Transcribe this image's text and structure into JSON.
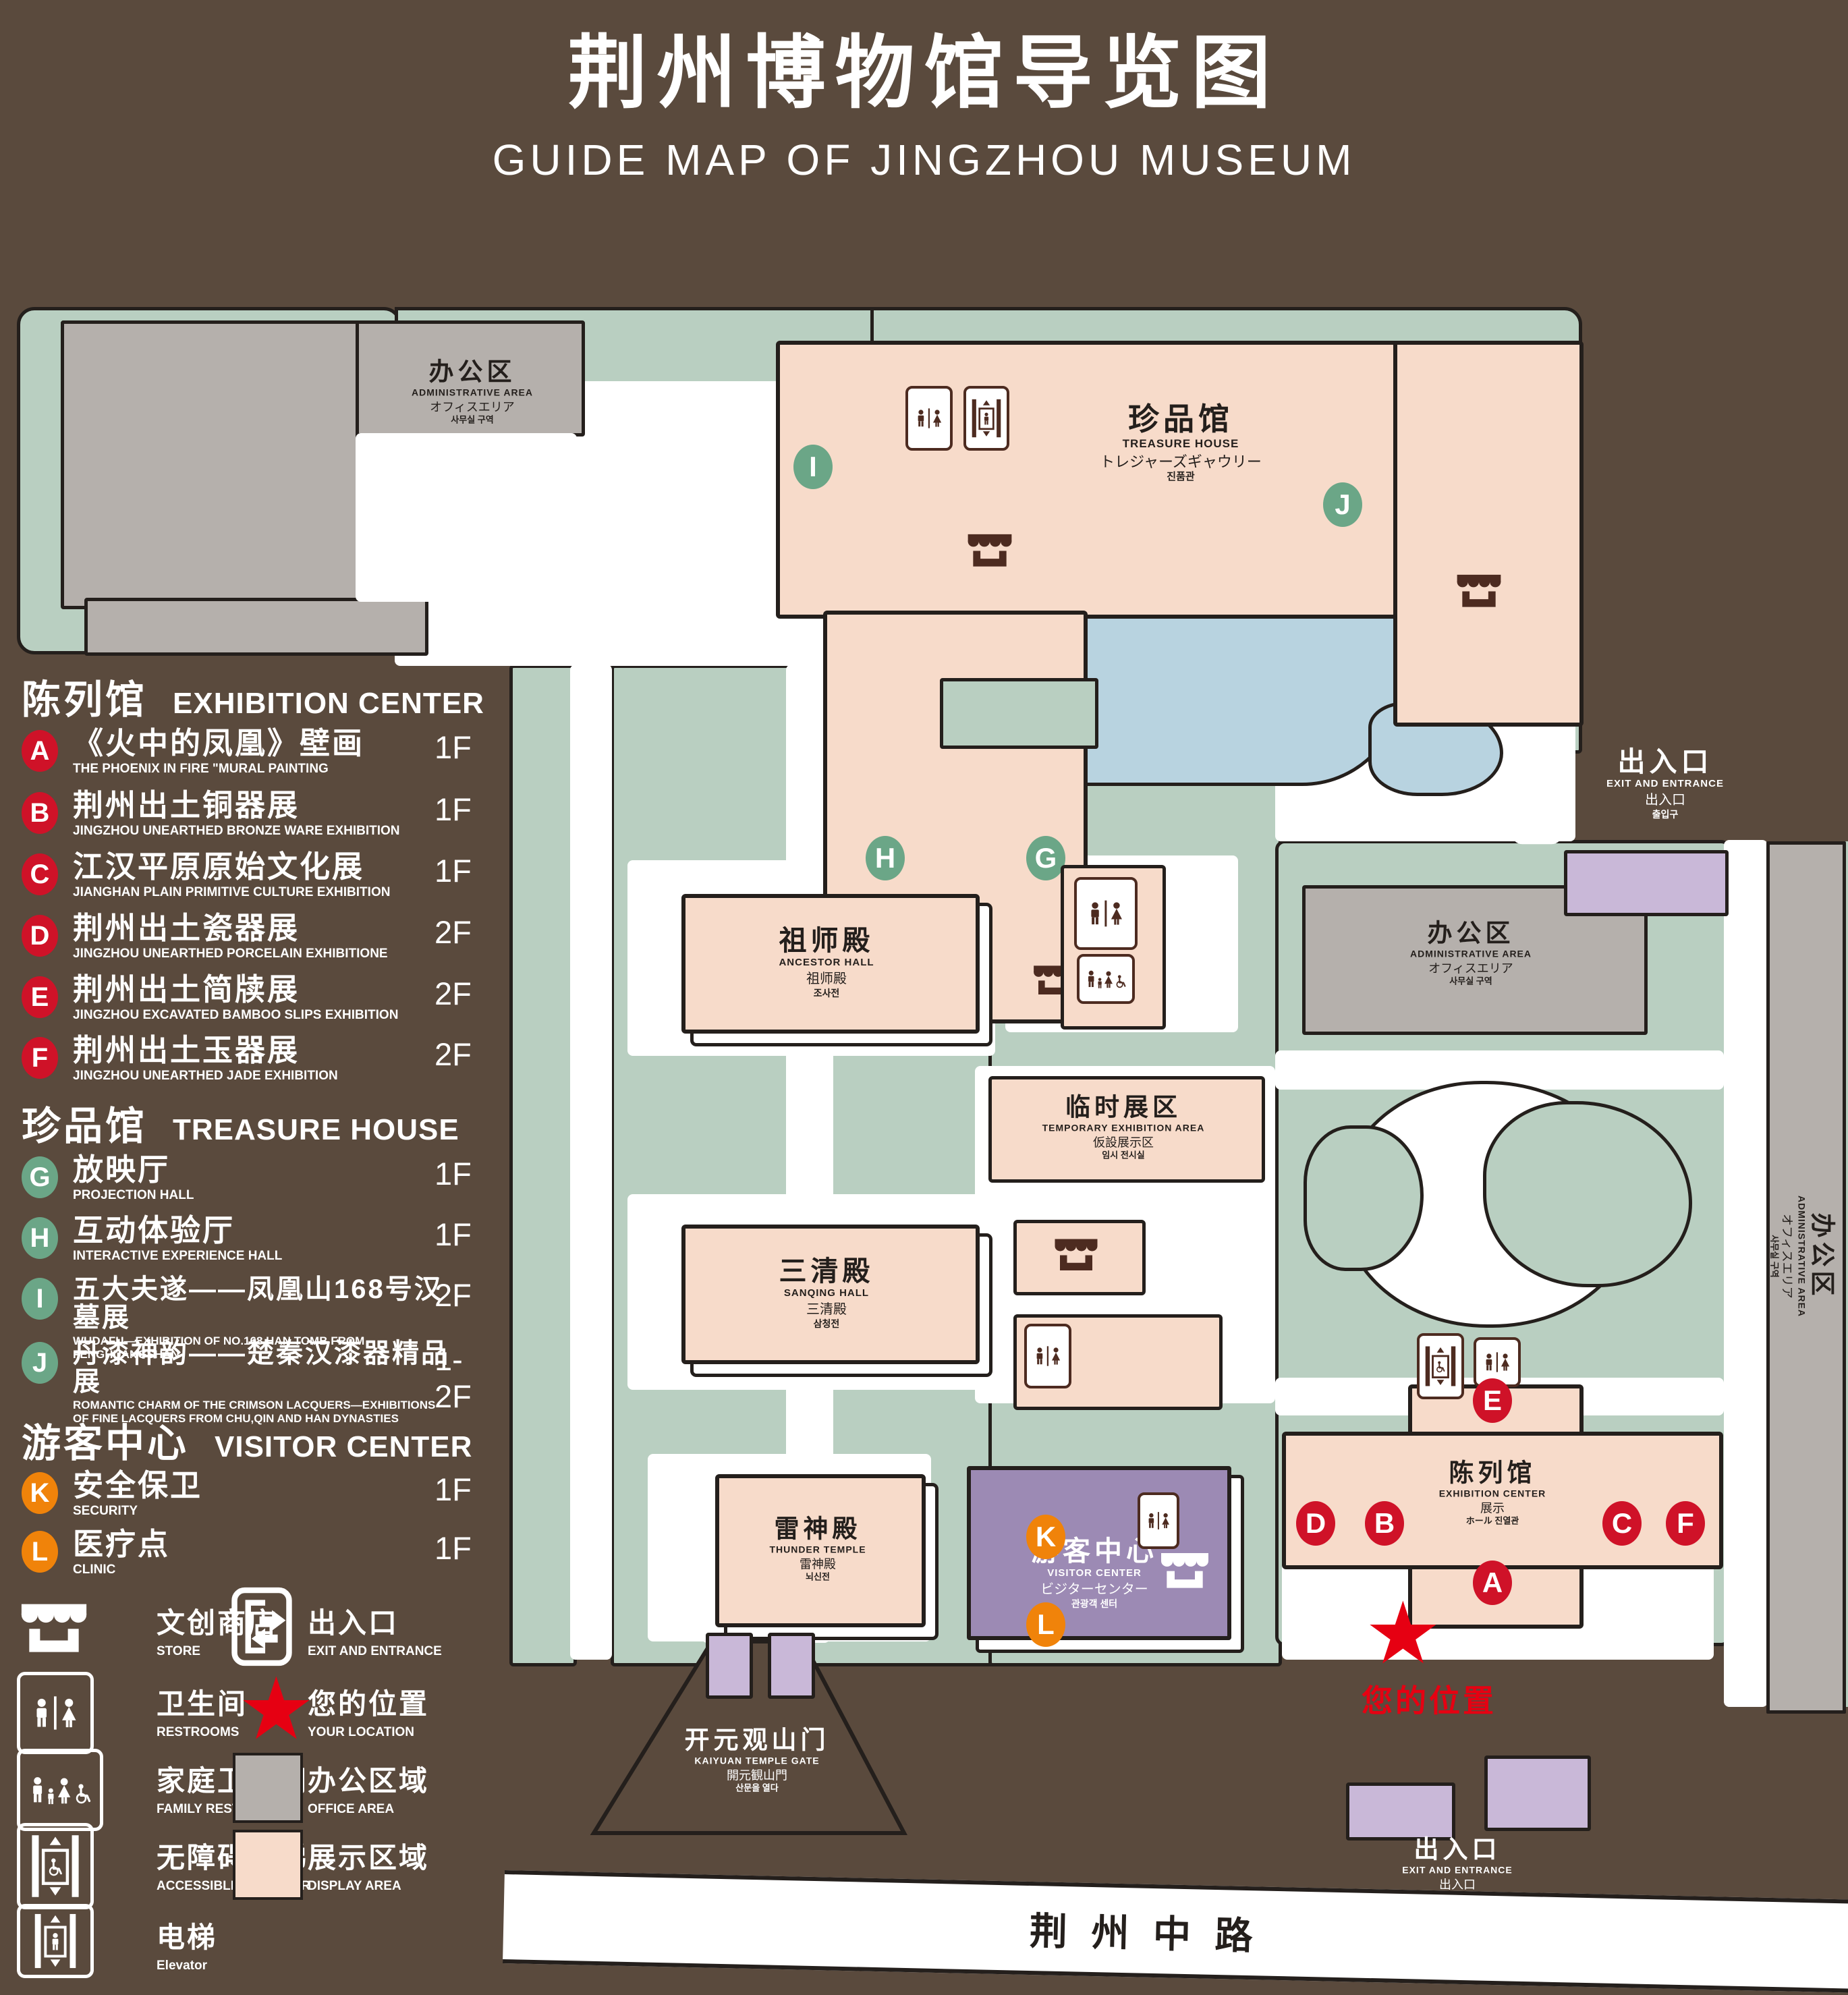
{
  "title": {
    "cn": "荆州博物馆导览图",
    "en": "GUIDE MAP OF JINGZHOU MUSEUM"
  },
  "legend": {
    "exhibition": {
      "cn": "陈列馆",
      "en": "EXHIBITION CENTER",
      "items": [
        {
          "key": "A",
          "cn": "《火中的凤凰》壁画",
          "en": "THE PHOENIX IN FIRE \"MURAL PAINTING",
          "floor": "1F"
        },
        {
          "key": "B",
          "cn": "荆州出土铜器展",
          "en": "JINGZHOU UNEARTHED BRONZE WARE EXHIBITION",
          "floor": "1F"
        },
        {
          "key": "C",
          "cn": "江汉平原原始文化展",
          "en": "JIANGHAN PLAIN PRIMITIVE CULTURE EXHIBITION",
          "floor": "1F"
        },
        {
          "key": "D",
          "cn": "荆州出土瓷器展",
          "en": "JINGZHOU UNEARTHED PORCELAIN EXHIBITIONE",
          "floor": "2F"
        },
        {
          "key": "E",
          "cn": "荆州出土简牍展",
          "en": "JINGZHOU EXCAVATED BAMBOO SLIPS EXHIBITION",
          "floor": "2F"
        },
        {
          "key": "F",
          "cn": "荆州出土玉器展",
          "en": "JINGZHOU UNEARTHED JADE EXHIBITION",
          "floor": "2F"
        }
      ]
    },
    "treasure": {
      "cn": "珍品馆",
      "en": "TREASURE HOUSE",
      "items": [
        {
          "key": "G",
          "cn": "放映厅",
          "en": "PROJECTION HALL",
          "floor": "1F"
        },
        {
          "key": "H",
          "cn": "互动体验厅",
          "en": "INTERACTIVE EXPERIENCE HALL",
          "floor": "1F"
        },
        {
          "key": "I",
          "cn": "五大夫遂——凤凰山168号汉墓展",
          "en": "WUDAFU—EXHIBITION OF NO.168 HAN TOMB FROM FENGHUANGSHAN",
          "floor": "2F"
        },
        {
          "key": "J",
          "cn": "丹漆神韵——楚秦汉漆器精品展",
          "en": "ROMANTIC CHARM OF THE CRIMSON LACQUERS—EXHIBITIONS OF FINE LACQUERS FROM CHU,QIN AND HAN DYNASTIES",
          "floor": "1-2F"
        }
      ]
    },
    "visitor": {
      "cn": "游客中心",
      "en": "VISITOR CENTER",
      "items": [
        {
          "key": "K",
          "cn": "安全保卫",
          "en": "SECURITY",
          "floor": "1F"
        },
        {
          "key": "L",
          "cn": "医疗点",
          "en": "CLINIC",
          "floor": "1F"
        }
      ]
    },
    "facilities": [
      {
        "icon": "store-icon",
        "cn": "文创商店",
        "en": "STORE"
      },
      {
        "icon": "exit-icon",
        "cn": "出入口",
        "en": "EXIT AND ENTRANCE"
      },
      {
        "icon": "restroom-icon",
        "cn": "卫生间",
        "en": "RESTROOMS"
      },
      {
        "icon": "location-star-icon",
        "cn": "您的位置",
        "en": "YOUR LOCATION"
      },
      {
        "icon": "family-restroom-icon",
        "cn": "家庭卫生间",
        "en": "FAMILY RESTROOMS"
      },
      {
        "icon": "office-area-swatch",
        "cn": "办公区域",
        "en": "OFFICE AREA"
      },
      {
        "icon": "accessible-elevator-icon",
        "cn": "无障碍电梯",
        "en": "ACCESSIBLE ELEVATOR"
      },
      {
        "icon": "display-area-swatch",
        "cn": "展示区域",
        "en": "DISPLAY AREA"
      },
      {
        "icon": "elevator-icon",
        "cn": "电梯",
        "en": "Elevator"
      }
    ]
  },
  "map": {
    "admin": {
      "cn": "办公区",
      "en": "ADMINISTRATIVE AREA",
      "jp": "オフィスエリア",
      "kr": "사무실 구역"
    },
    "treasure_house": {
      "cn": "珍品馆",
      "en": "TREASURE HOUSE",
      "jp": "トレジャーズギャウリー",
      "kr": "진품관"
    },
    "ancestor_hall": {
      "cn": "祖师殿",
      "en": "ANCESTOR HALL",
      "jp": "祖师殿",
      "kr": "조사전"
    },
    "sanqing_hall": {
      "cn": "三清殿",
      "en": "SANQING HALL",
      "jp": "三清殿",
      "kr": "삼청전"
    },
    "thunder_temple": {
      "cn": "雷神殿",
      "en": "THUNDER TEMPLE",
      "jp": "雷神殿",
      "kr": "뇌신전"
    },
    "temporary_area": {
      "cn": "临时展区",
      "en": "TEMPORARY EXHIBITION AREA",
      "jp": "仮設展示区",
      "kr": "임시 전시실"
    },
    "visitor_center": {
      "cn": "游客中心",
      "en": "VISITOR CENTER",
      "jp": "ビジターセンター",
      "kr": "관광객 센터"
    },
    "exhibition_center": {
      "cn": "陈列馆",
      "en": "EXHIBITION CENTER",
      "jp": "展示",
      "kr": "ホール 진열관"
    },
    "gate": {
      "cn": "开元观山门",
      "en": "KAIYUAN TEMPLE GATE",
      "jp": "開元観山門",
      "kr": "산문을 열다"
    },
    "exit": {
      "cn": "出入口",
      "en": "EXIT AND ENTRANCE",
      "jp": "出入口",
      "kr": "출입구"
    },
    "road": "荆 州 中 路",
    "your_location": "您的位置",
    "markers": {
      "a": "A",
      "b": "B",
      "c": "C",
      "d": "D",
      "e": "E",
      "f": "F",
      "g": "G",
      "h": "H",
      "i": "I",
      "j": "J",
      "k": "K",
      "l": "L"
    }
  },
  "colors": {
    "background": "#5a4a3d",
    "park_green": "#b9cfc1",
    "display_pink": "#f7dbca",
    "office_gray": "#b5b0ac",
    "pond_blue": "#b8d3e0",
    "visitor_purple": "#9c8ab4",
    "entrance_purple": "#c9b8d8",
    "marker_red": "#cf1228",
    "marker_green": "#6ba687",
    "marker_orange": "#f0830a",
    "location_red": "#e60012",
    "outline": "#241f1c"
  }
}
